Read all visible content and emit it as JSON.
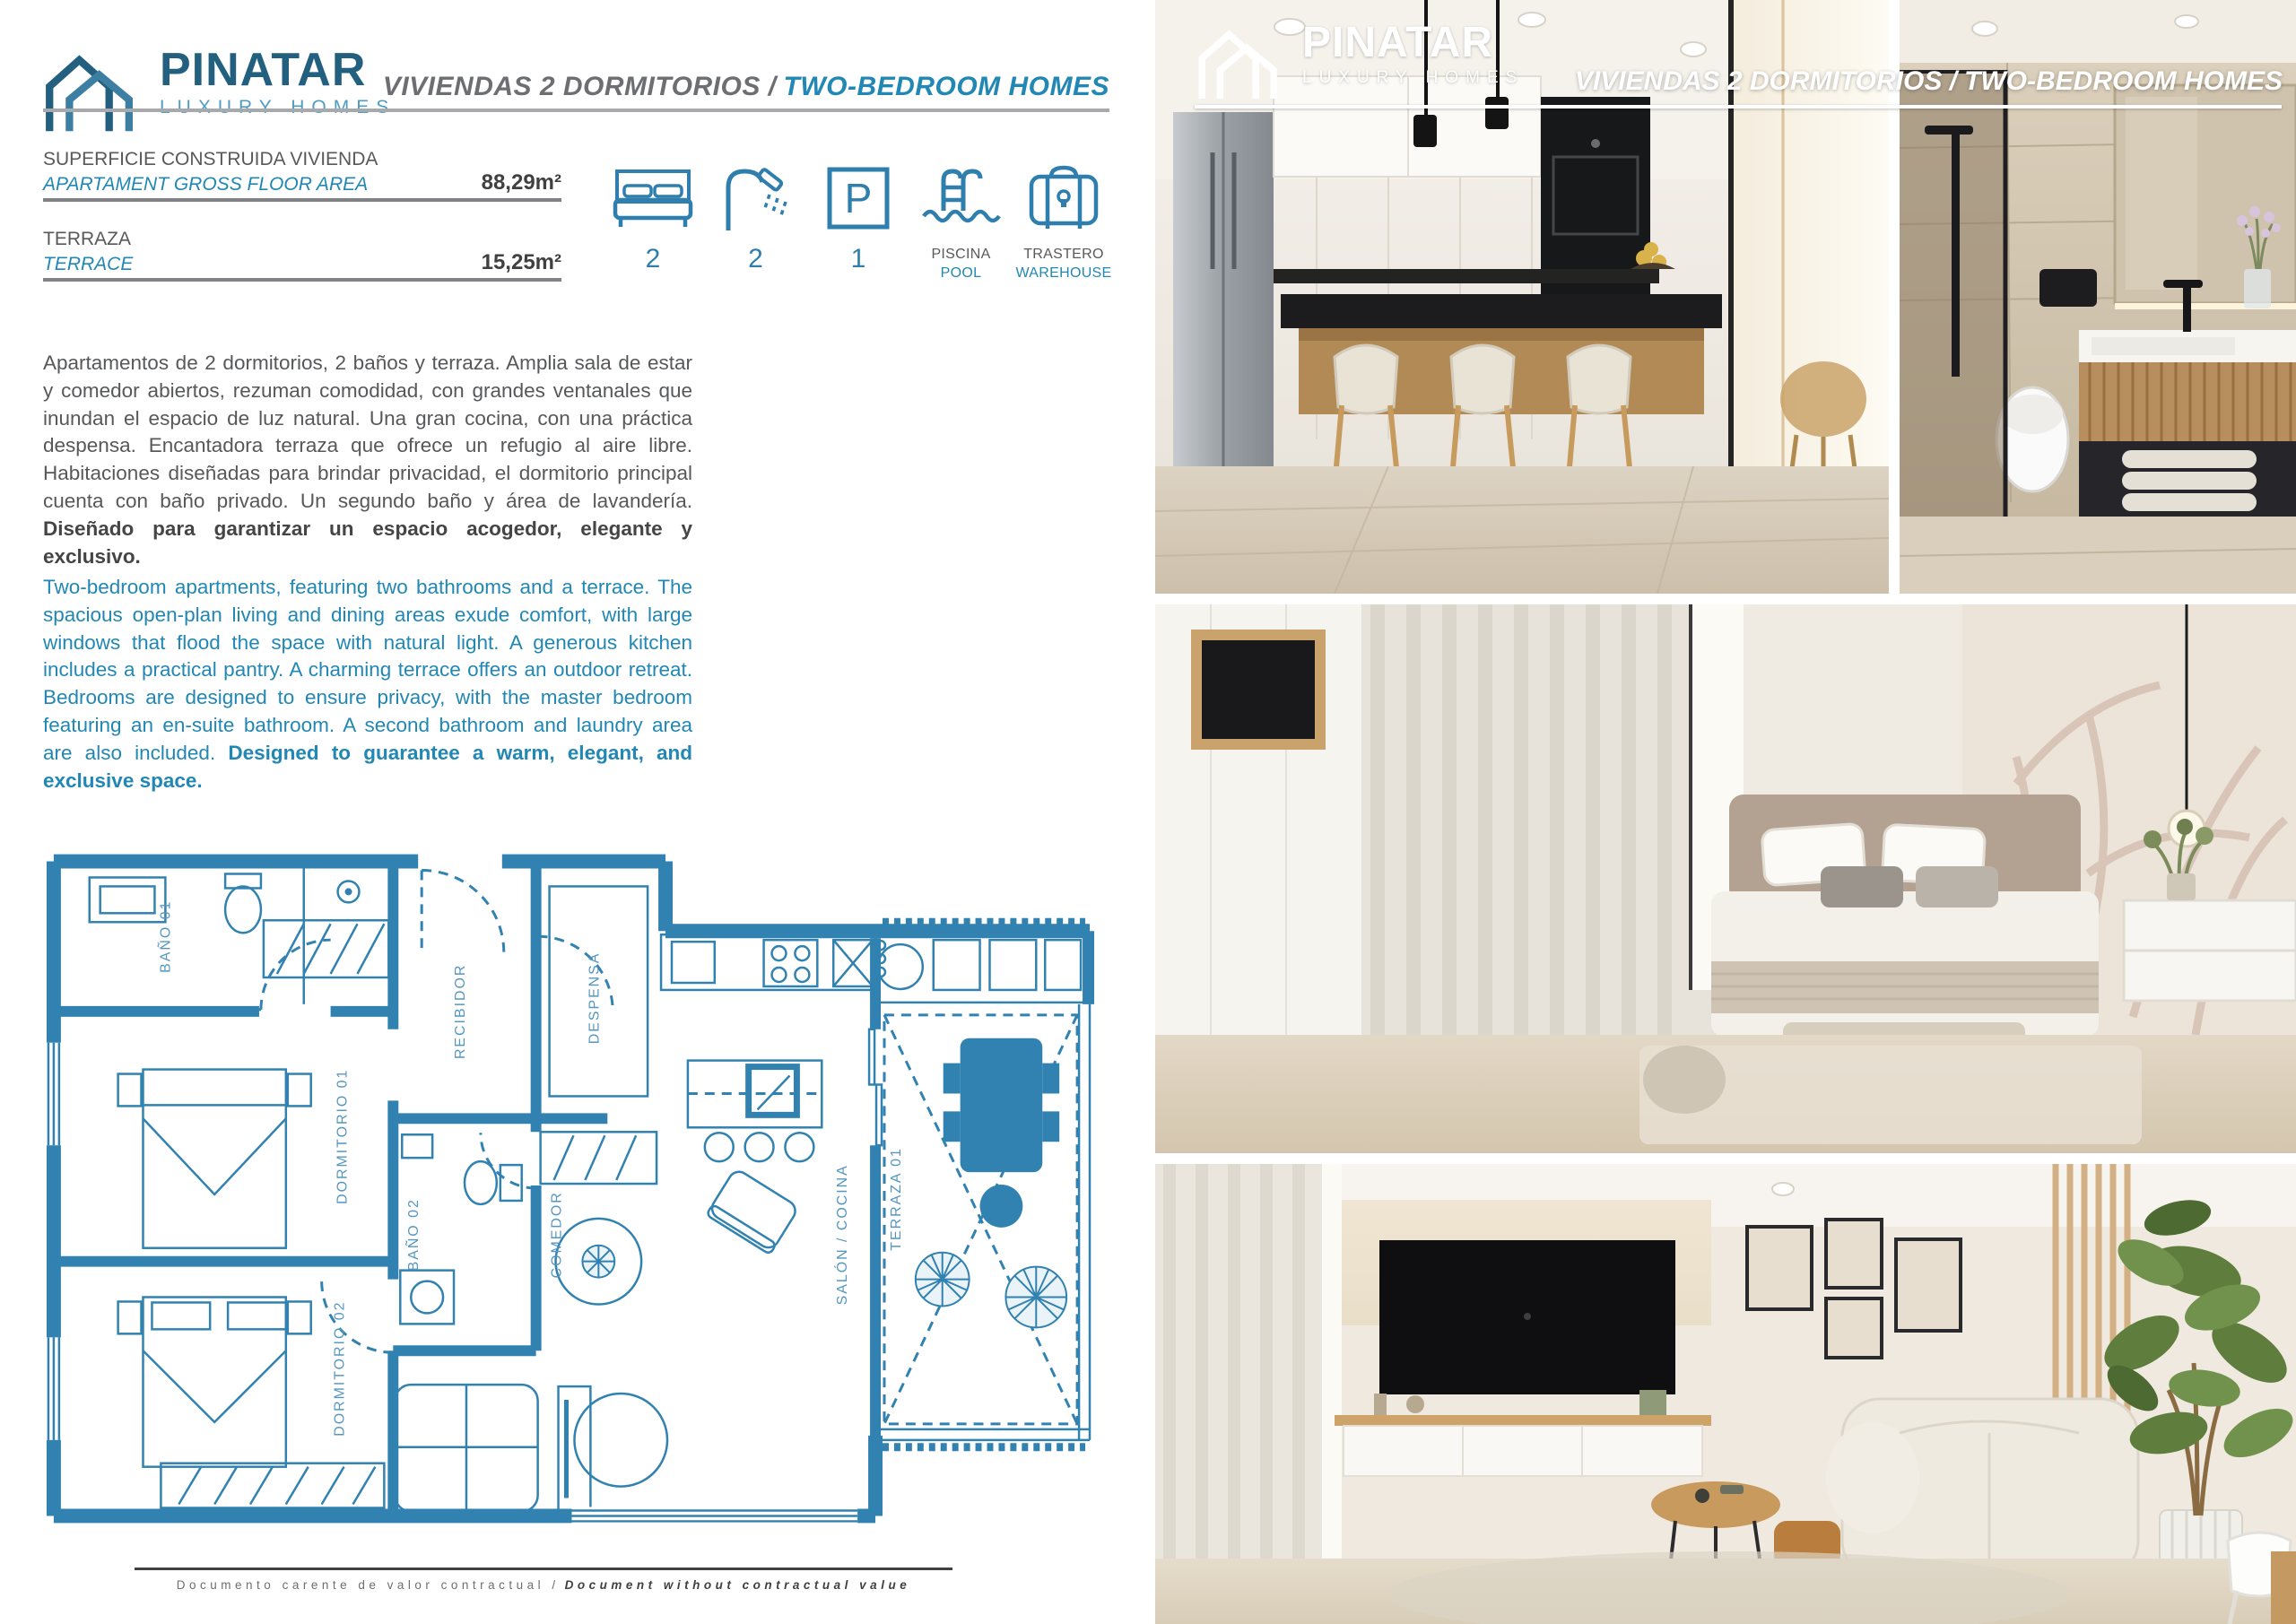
{
  "colors": {
    "accent_blue": "#2187b4",
    "dark_blue": "#23607f",
    "logo_light_blue": "#4f9dc3",
    "text_gray": "#58595b",
    "plan_blue": "#3182b0",
    "rule_gray": "#a7a9ac"
  },
  "logo": {
    "name": "PINATAR",
    "tagline": "LUXURY HOMES",
    "icon": "double-gable-house-icon"
  },
  "header": {
    "title_es": "VIVIENDAS 2 DORMITORIOS /",
    "title_en": "TWO-BEDROOM HOMES"
  },
  "specs": [
    {
      "label_es": "SUPERFICIE CONSTRUIDA VIVIENDA",
      "label_en": "APARTAMENT GROSS FLOOR AREA",
      "value": "88,29m²"
    },
    {
      "label_es": "TERRAZA",
      "label_en": "TERRACE",
      "value": "15,25m²"
    }
  ],
  "features": [
    {
      "icon": "bed-icon",
      "value": "2"
    },
    {
      "icon": "shower-icon",
      "value": "2"
    },
    {
      "icon": "parking-icon",
      "value": "1",
      "glyph": "P"
    },
    {
      "icon": "pool-icon",
      "label_es": "PISCINA",
      "label_en": "POOL"
    },
    {
      "icon": "warehouse-icon",
      "label_es": "TRASTERO",
      "label_en": "WAREHOUSE"
    }
  ],
  "description_es": {
    "body": "Apartamentos de 2 dormitorios, 2 baños y terraza. Amplia sala de estar y comedor abiertos, rezuman comodidad, con grandes ventanales que inundan el espacio de luz natural. Una gran cocina, con una práctica despensa. Encantadora terraza que ofrece un refugio al aire libre. Habitaciones diseñadas para brindar privacidad, el dormitorio principal cuenta con baño privado. Un segundo baño y área de lavandería. ",
    "bold": "Diseñado para garantizar un espacio acogedor, elegante y exclusivo."
  },
  "description_en": {
    "body": "Two-bedroom apartments, featuring two bathrooms and a terrace. The spacious open-plan living and dining areas exude comfort, with large windows that flood the space with natural light. A generous kitchen includes a practical pantry. A charming terrace offers an outdoor retreat. Bedrooms are designed to ensure privacy, with the master bedroom featuring an en-suite bathroom. A second bathroom and laundry area are also included. ",
    "bold": "Designed to guarantee a warm, elegant, and exclusive space."
  },
  "floorplan": {
    "rooms": {
      "bano1": "BAÑO 01",
      "dormitorio1": "DORMITORIO 01",
      "dormitorio2": "DORMITORIO 02",
      "bano2": "BAÑO 02",
      "recibidor": "RECIBIDOR",
      "despensa": "DESPENSA",
      "comedor": "COMEDOR",
      "salon": "SALÓN / COCINA",
      "terraza": "TERRAZA 01"
    }
  },
  "footer": {
    "disclaimer_es": "Documento carente de valor contractual /",
    "disclaimer_en": "Document without contractual value"
  }
}
